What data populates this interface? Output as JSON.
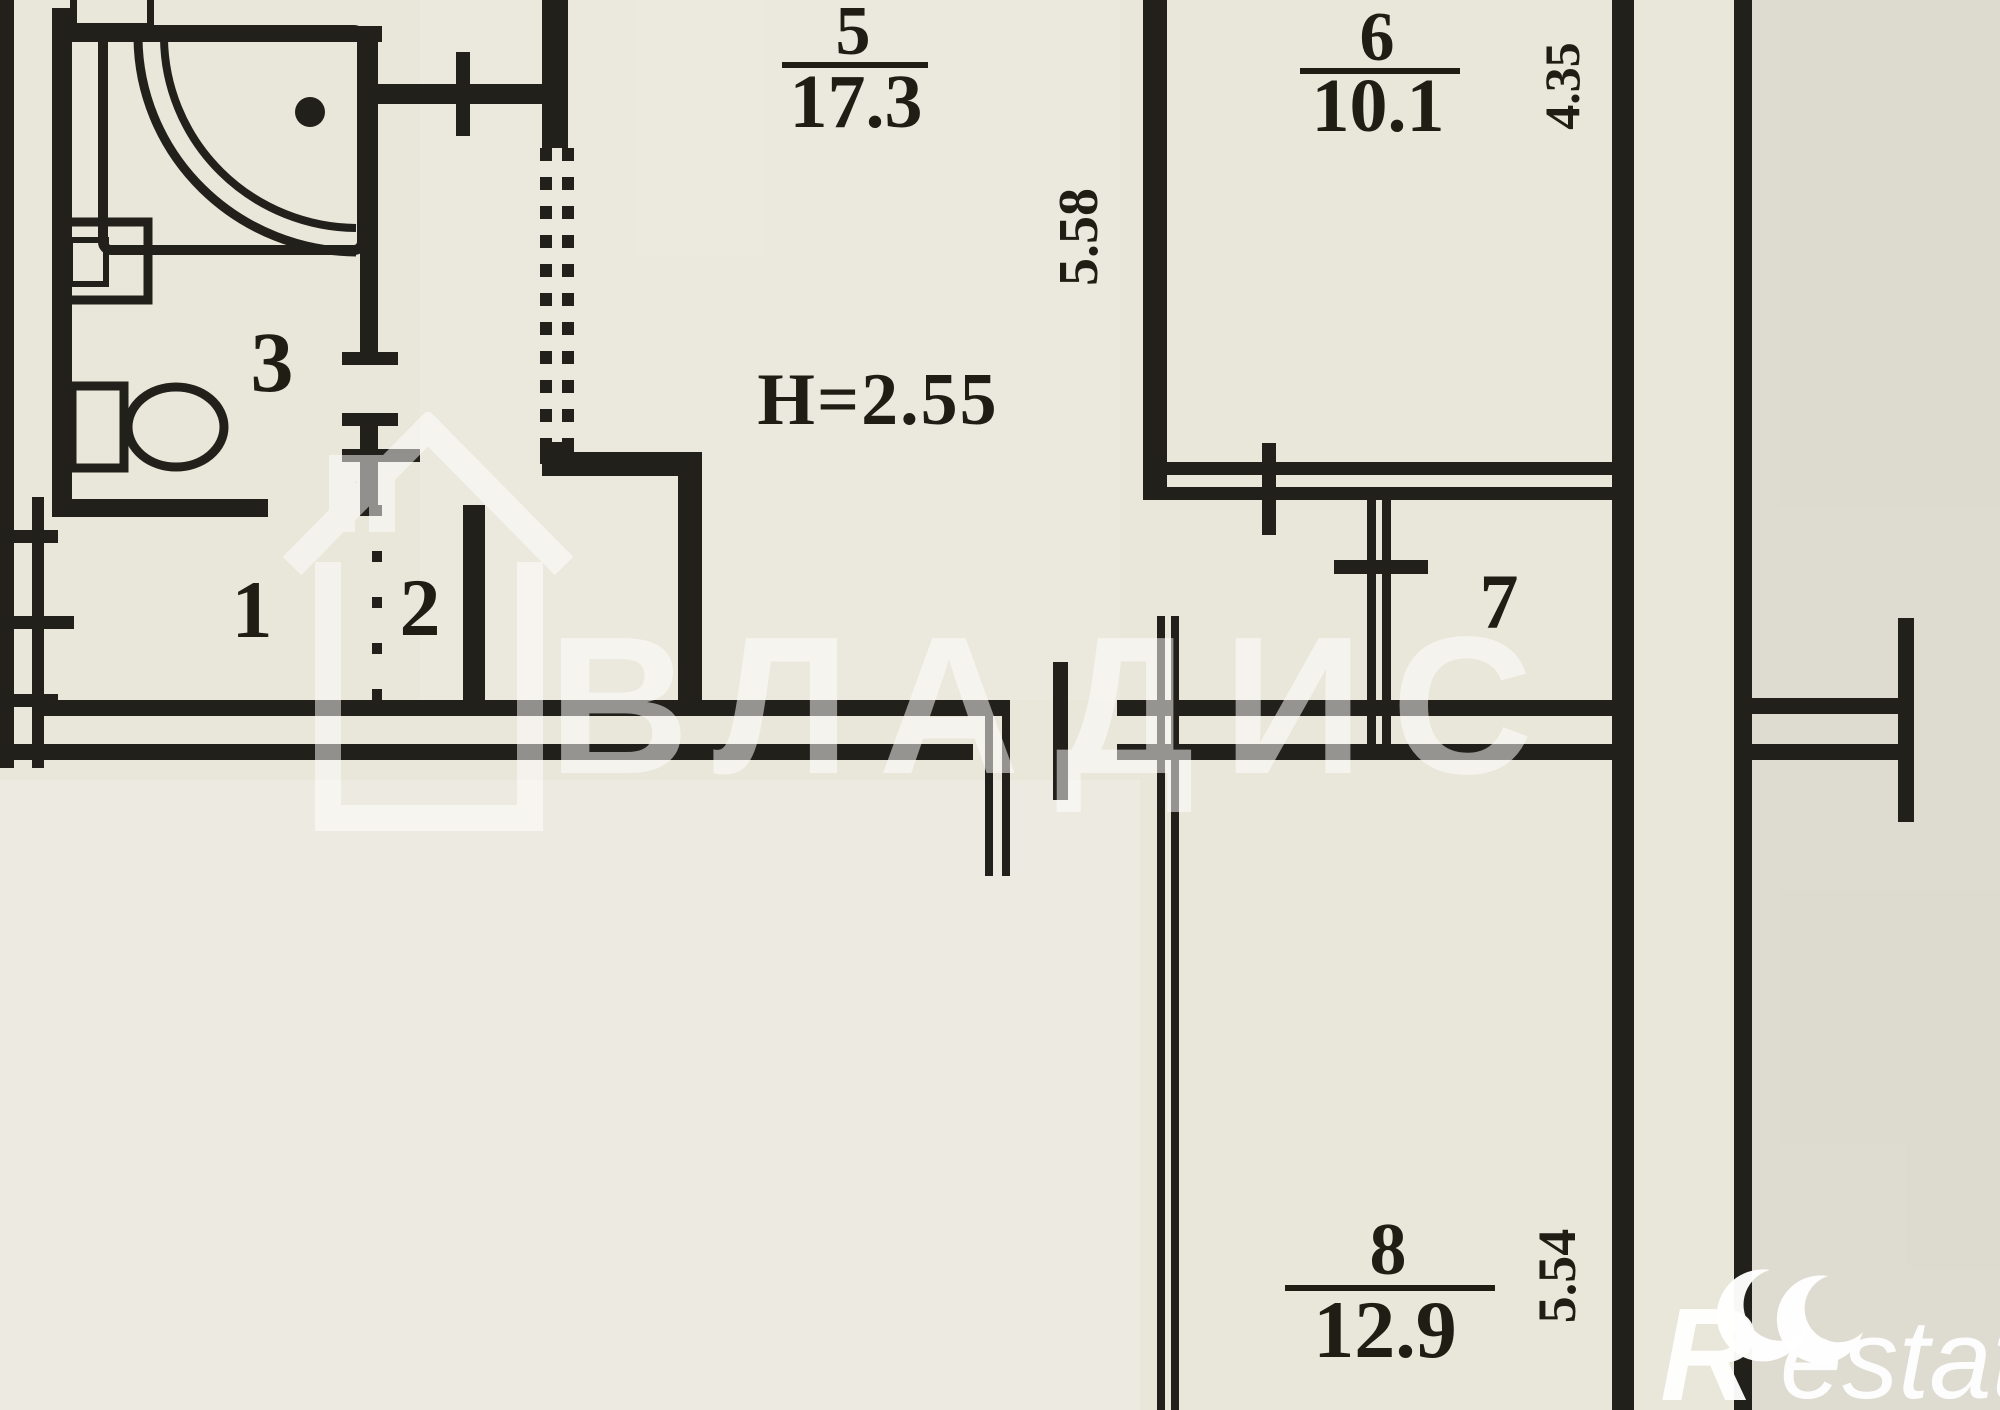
{
  "plan": {
    "rooms": [
      {
        "number": "5",
        "area": "17.3"
      },
      {
        "number": "6",
        "area": "10.1"
      },
      {
        "number": "8",
        "area": "12.9"
      },
      {
        "number": "1",
        "area": ""
      },
      {
        "number": "2",
        "area": ""
      },
      {
        "number": "3",
        "area": ""
      },
      {
        "number": "7",
        "area": ""
      }
    ],
    "height_note": "H=2.55",
    "dimensions": [
      "5.58",
      "4.35",
      "5.54"
    ]
  },
  "watermarks": {
    "agency": "ВЛАДИС",
    "logo_r": "R",
    "logo_rest": "estate"
  },
  "colors": {
    "paper": "#e9e6da",
    "ink": "#22201a",
    "watermark": "#ffffff"
  }
}
